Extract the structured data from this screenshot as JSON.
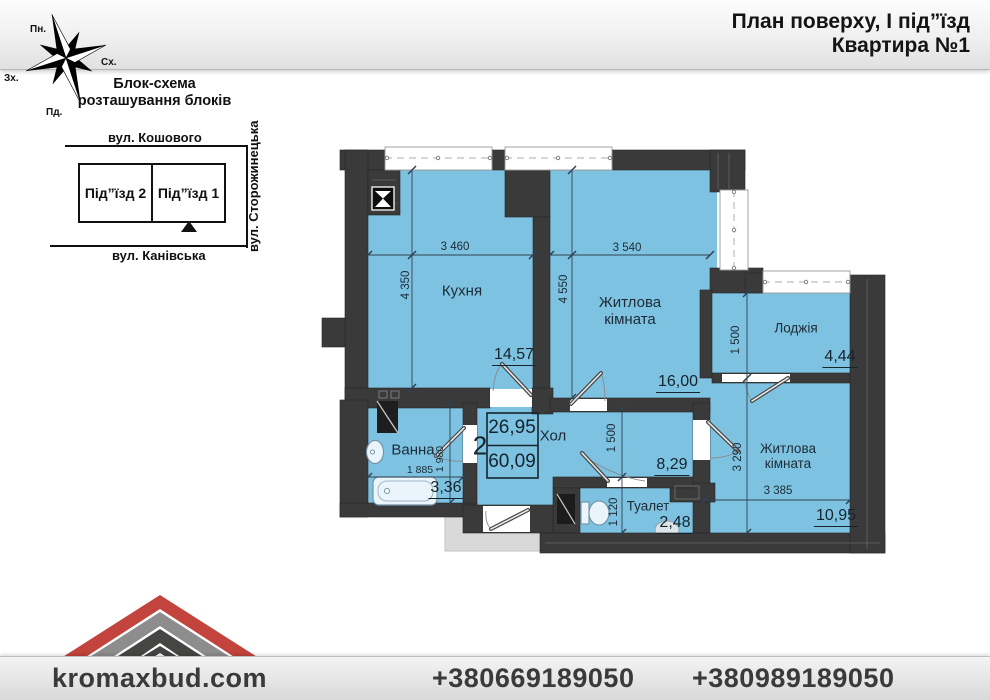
{
  "header": {
    "line1": "План поверху, І під”їзд",
    "line2": "Квартира №1"
  },
  "compass": {
    "north": "Пн.",
    "east": "Сх.",
    "west": "Зх.",
    "south": "Пд."
  },
  "block_schema": {
    "title_line1": "Блок-схема",
    "title_line2": "розташування блоків",
    "street_top": "вул. Кошового",
    "street_bottom": "вул. Канівська",
    "street_right": "вул. Сторожинецька",
    "entrance_left": "Під”їзд 2",
    "entrance_right": "Під”їзд 1"
  },
  "stamp": {
    "rooms": "2",
    "living_area": "26,95",
    "total_area": "60,09"
  },
  "rooms": {
    "kitchen": {
      "name": "Кухня",
      "area": "14,57",
      "width": "3 460",
      "height": "4 350"
    },
    "living1": {
      "name": "Житлова кімната",
      "area": "16,00",
      "width": "3 540",
      "height": "4 550"
    },
    "living2": {
      "name": "Житлова кімната",
      "area": "10,95",
      "width": "3 385",
      "height": "3 290"
    },
    "loggia": {
      "name": "Лоджія",
      "area": "4,44",
      "height": "1 500"
    },
    "hall": {
      "name": "Хол",
      "area": "8,29",
      "height": "1 500"
    },
    "toilet": {
      "name": "Туалет",
      "area": "2,48",
      "height": "1 120"
    },
    "bath": {
      "name": "Ванна",
      "area": "3,36",
      "width": "1 885",
      "height": "1 980"
    }
  },
  "footer": {
    "site": "kromaxbud.com",
    "phone1": "+380669189050",
    "phone2": "+380989189050"
  },
  "colors": {
    "room_fill": "#7dc2e0",
    "wall": "#3a3a3a",
    "accent_red": "#c2443c"
  }
}
